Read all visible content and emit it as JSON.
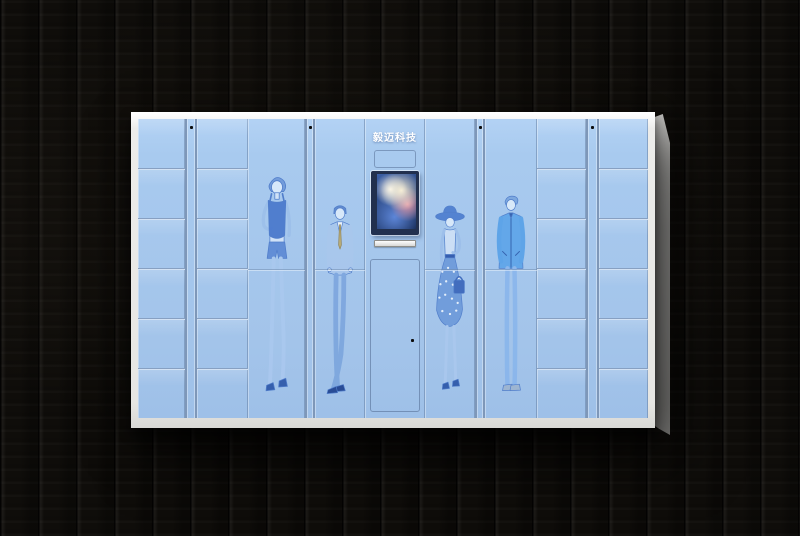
{
  "brand": {
    "logo_text": "毅迈科技"
  },
  "colors": {
    "bg": "#0f0d0a",
    "face-blue": "#a8caef",
    "shell-white": "#e6e6e3",
    "side-gray": "#b3b2af",
    "divider-dark": "#87a0c2",
    "divider-light": "#d3e2f4",
    "screen-bezel": "#22304e",
    "lock-dot": "#0c0c0c",
    "logo-color": "#ffffff",
    "figure-outline": "#4a78c8",
    "figure-dark": "#3f6fc9",
    "figure-mid": "#6d9ada",
    "figure-sky": "#58a2e8",
    "figure-light": "#cfe0f6",
    "skin": "#dcebfb",
    "tie-tan": "#b9a96e"
  },
  "cabinet": {
    "small_locker_columns": 4,
    "doors_per_small_column": 6,
    "tall_display_doors": 4,
    "figure_prints": [
      "woman-tank-top-shorts",
      "man-business-suit",
      "woman-sun-hat-polka-skirt",
      "man-casual-jacket-jeans"
    ],
    "console": {
      "screen": "color-touch-screen",
      "slot": "card-slot",
      "door": "service-door"
    }
  }
}
